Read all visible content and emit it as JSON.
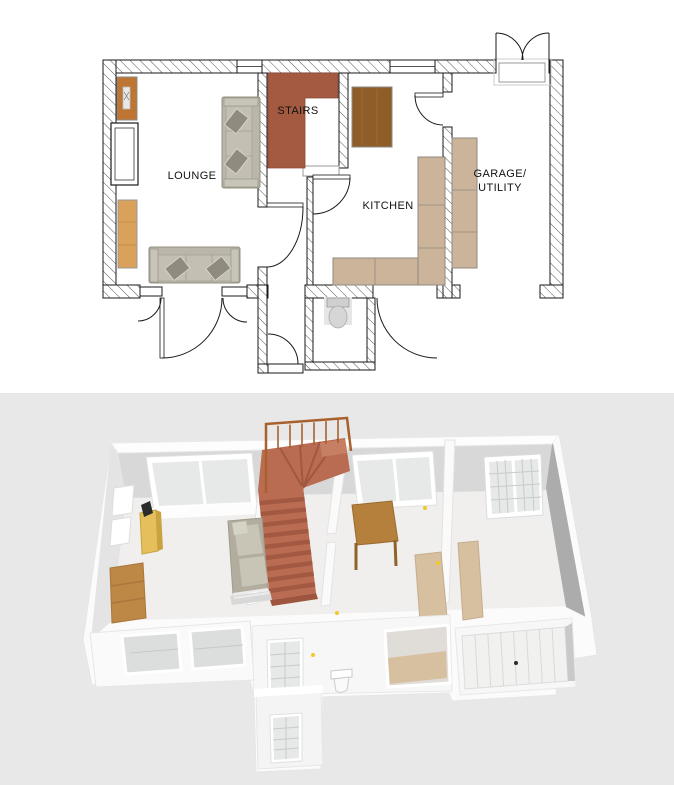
{
  "page": {
    "background": "#ffffff"
  },
  "floor_plan_2d": {
    "name": "ground-floor-plan",
    "labels": {
      "lounge": "LOUNGE",
      "stairs": "STAIRS",
      "kitchen": "KITCHEN",
      "garage_line1": "GARAGE/",
      "garage_line2": "UTILITY"
    },
    "colors": {
      "outline": "#1a1a1a",
      "hatch": "#555555",
      "stairs": "#a35a40",
      "table": "#8f5d28",
      "counter": "#cbb49a",
      "cabinet_dark": "#bd7531",
      "cabinet_light": "#d9a159",
      "sofa": "#bab6a9",
      "sofa_cushion": "#8f8b7e",
      "fixture": "#d6d6d6",
      "frame_gray": "#999999"
    },
    "objects": [
      "hatched exterior walls",
      "L-shaped staircase",
      "sofa against stairs wall",
      "sofa at front wall",
      "kitchen table",
      "kitchen counters",
      "garage shelving",
      "wall cabinets",
      "recessed shelf",
      "toilet",
      "door swing arcs",
      "garage double doors at rear",
      "front porch",
      "wc"
    ]
  },
  "view_3d": {
    "name": "3d-dollhouse-view",
    "colors": {
      "background": "#e8e8e8",
      "wall_white": "#fbfbfb",
      "wall_inner": "#d8d8d8",
      "wall_shadow": "#acacac",
      "wall_light": "#e4e4e4",
      "floor": "#f0efee",
      "stairs": "#b96c52",
      "stairs_riser": "#a15840",
      "railing": "#a8602c",
      "glass": "#e7e9e9",
      "grid": "#c6cbcd",
      "counter": "#d6c0a0",
      "table": "#b5803c",
      "sofa": "#b2ad9e",
      "cabinet_gold": "#e4bf5c",
      "sideboard": "#bd8746",
      "handle": "#f0c929"
    },
    "objects": [
      "white perspective walls",
      "terracotta staircase with copper railing",
      "sofa",
      "gold cabinet",
      "wood sideboard",
      "kitchen table",
      "tan counters",
      "rear windows",
      "garage french doors",
      "front bay windows",
      "porch with glazed doors",
      "toilet",
      "panelled garage door"
    ]
  }
}
